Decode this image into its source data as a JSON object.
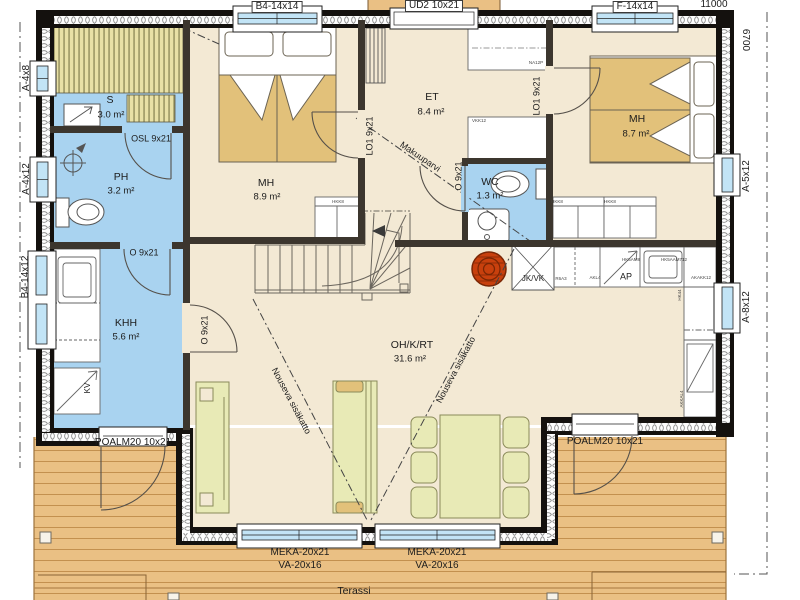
{
  "colors": {
    "floor": "#f3e9d4",
    "wet": "#a9d3f0",
    "terrace": "#eac084",
    "wall": "#14110e",
    "furniture": "#e8eab6",
    "blanket": "#e2c17a",
    "fireplace": "#c8400d",
    "glass": "#c2e4f6",
    "bench": "#e9e1a6"
  },
  "dimensions": {
    "width_mm": "11000",
    "depth_mm": "6700"
  },
  "rooms": {
    "sauna": {
      "name": "S",
      "area": "3.0 m²"
    },
    "bathroom": {
      "name": "PH",
      "area": "3.2 m²"
    },
    "utility": {
      "name": "KHH",
      "area": "5.6 m²"
    },
    "bedroom_left": {
      "name": "MH",
      "area": "8.9 m²"
    },
    "entry": {
      "name": "ET",
      "area": "8.4 m²"
    },
    "wc": {
      "name": "WC",
      "area": "1.3 m²"
    },
    "bedroom_right": {
      "name": "MH",
      "area": "8.7 m²"
    },
    "living_kitchen": {
      "name": "OH/K/RT",
      "area": "31.6 m²"
    },
    "terrace": {
      "name": "Terassi"
    }
  },
  "windows": {
    "b4_top": "B4-14x14",
    "f_top": "F-14x14",
    "a4x8": "A-4x8",
    "a4x12": "A-4x12",
    "b4_left": "B4-14x12",
    "a5x12": "A-5x12",
    "a8x12": "A-8x12",
    "bay_left_type": "MEKA-20x21",
    "bay_left_size": "VA-20x16",
    "bay_right_type": "MEKA-20x21",
    "bay_right_size": "VA-20x16"
  },
  "doors": {
    "entrance": "UD2 10x21",
    "terrace_left": "POALM20 10x21",
    "terrace_right": "POALM20 10x21",
    "sauna": "OSL 9x21",
    "bathroom": "O 9x21",
    "utility": "O 9x21",
    "wc": "O 9x21",
    "bedroom_left": "LO1 9x21",
    "bedroom_right": "LO1 9x21"
  },
  "annotations": {
    "loft": "Makuuparvi",
    "rising_ceiling_left": "Nouseva sisäkatto",
    "rising_ceiling_right": "Nouseva sisäkatto"
  },
  "appliances": {
    "fridge_freezer": "JK/VK",
    "dishwasher": "AP",
    "drying_cabinet": "KV"
  },
  "cabinet_codes": {
    "entry_wardrobe": "NA12P",
    "entry_closet": "VKK12",
    "bedroom_left_closet": "HKK8",
    "bedroom_right_closet_a": "HKK8",
    "bedroom_right_closet_b": "HKK8",
    "kitchen_a": "R6A3",
    "kitchen_b": "AKL4",
    "kitchen_c": "HK5AM8",
    "kitchen_d": "HK5AAM712",
    "kitchen_e": "AKAKK12",
    "kitchen_f": "AKKAL4",
    "kitchen_g": "HK44"
  }
}
